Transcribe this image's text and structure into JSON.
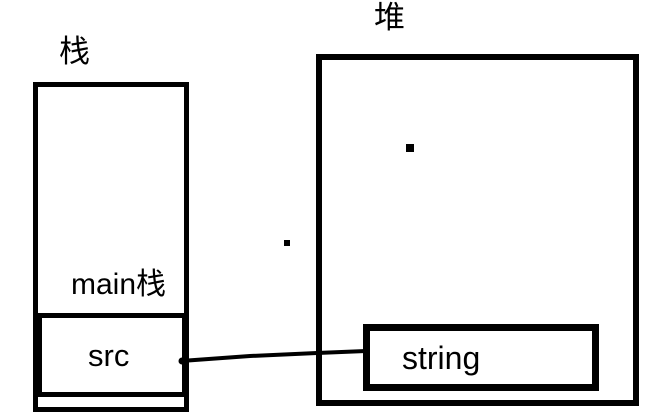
{
  "colors": {
    "background": "#ffffff",
    "ink": "#000000"
  },
  "stack": {
    "title": "栈",
    "frame_label": "main栈",
    "slot_label": "src"
  },
  "heap": {
    "title": "堆",
    "block_label": "string"
  },
  "pointer": {
    "from_label": "src",
    "to_label": "string"
  }
}
